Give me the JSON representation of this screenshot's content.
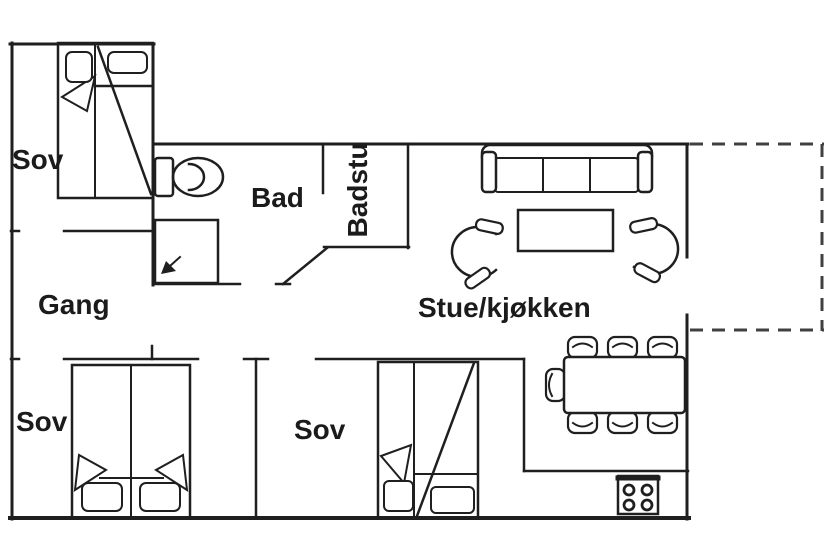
{
  "plan": {
    "rooms": {
      "sov_nw": {
        "label": "Sov"
      },
      "bad": {
        "label": "Bad"
      },
      "badstu": {
        "label": "Badstu"
      },
      "gang": {
        "label": "Gang"
      },
      "stue_kjokken": {
        "label": "Stue/kjøkken"
      },
      "sov_sw": {
        "label": "Sov"
      },
      "sov_s": {
        "label": "Sov"
      }
    },
    "furniture_icons": [
      "double-bed-icon",
      "pillow-icon",
      "toilet-icon",
      "shower-icon",
      "sofa-icon",
      "coffee-table-icon",
      "armchair-icon",
      "dining-table-icon",
      "dining-chair-icon",
      "stove-icon"
    ],
    "colors": {
      "wall_line": "#1f1f1f",
      "dashed_outline": "#404040",
      "background": "#ffffff",
      "text": "#1b1b1b"
    }
  }
}
